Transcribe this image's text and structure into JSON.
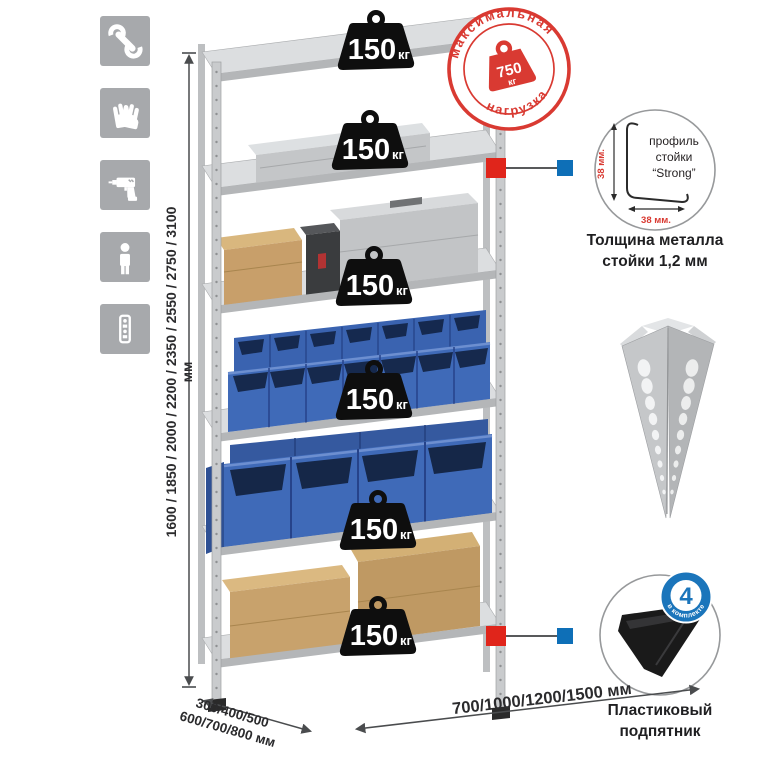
{
  "product": "metal-shelving-rack-infographic",
  "left_icons": {
    "tile_color": "#a7a9ac",
    "items": [
      {
        "name": "wrench"
      },
      {
        "name": "gloves"
      },
      {
        "name": "drill"
      },
      {
        "name": "person"
      },
      {
        "name": "rack-post"
      }
    ]
  },
  "height_dimension": {
    "label": "1600 / 1850 / 2000 / 2200 / 2350 / 2550 / 2750 / 3100 мм"
  },
  "shelf_load": {
    "value": "150",
    "unit": "кг",
    "badge_count": 6,
    "badge_color": "#0e0e0e"
  },
  "max_load_stamp": {
    "top_text": "максимальная",
    "bottom_text": "нагрузка",
    "value": "750",
    "unit": "кг",
    "color": "#d93a32"
  },
  "profile_detail": {
    "label_line1": "профиль",
    "label_line2": "стойки",
    "label_line3": "“Strong”",
    "dim_vertical": "38 мм.",
    "dim_horizontal": "38 мм.",
    "caption_line1": "Толщина металла",
    "caption_line2": "стойки 1,2 мм"
  },
  "foot_detail": {
    "badge_value": "4",
    "badge_arc": "в комплекте",
    "badge_color": "#1b75bb",
    "caption_line1": "Пластиковый",
    "caption_line2": "подпятник"
  },
  "depth_dimension": {
    "line1": "300/400/500",
    "line2": "600/700/800 мм"
  },
  "width_dimension": {
    "label": "700/1000/1200/1500 мм"
  },
  "colors": {
    "accent_red": "#d93a32",
    "callout_red": "#e0251b",
    "callout_blue": "#0e6fb7",
    "bin_blue": "#3f6ab8",
    "metal_gray": "#c9cbcd",
    "cardboard": "#c8a26c"
  }
}
